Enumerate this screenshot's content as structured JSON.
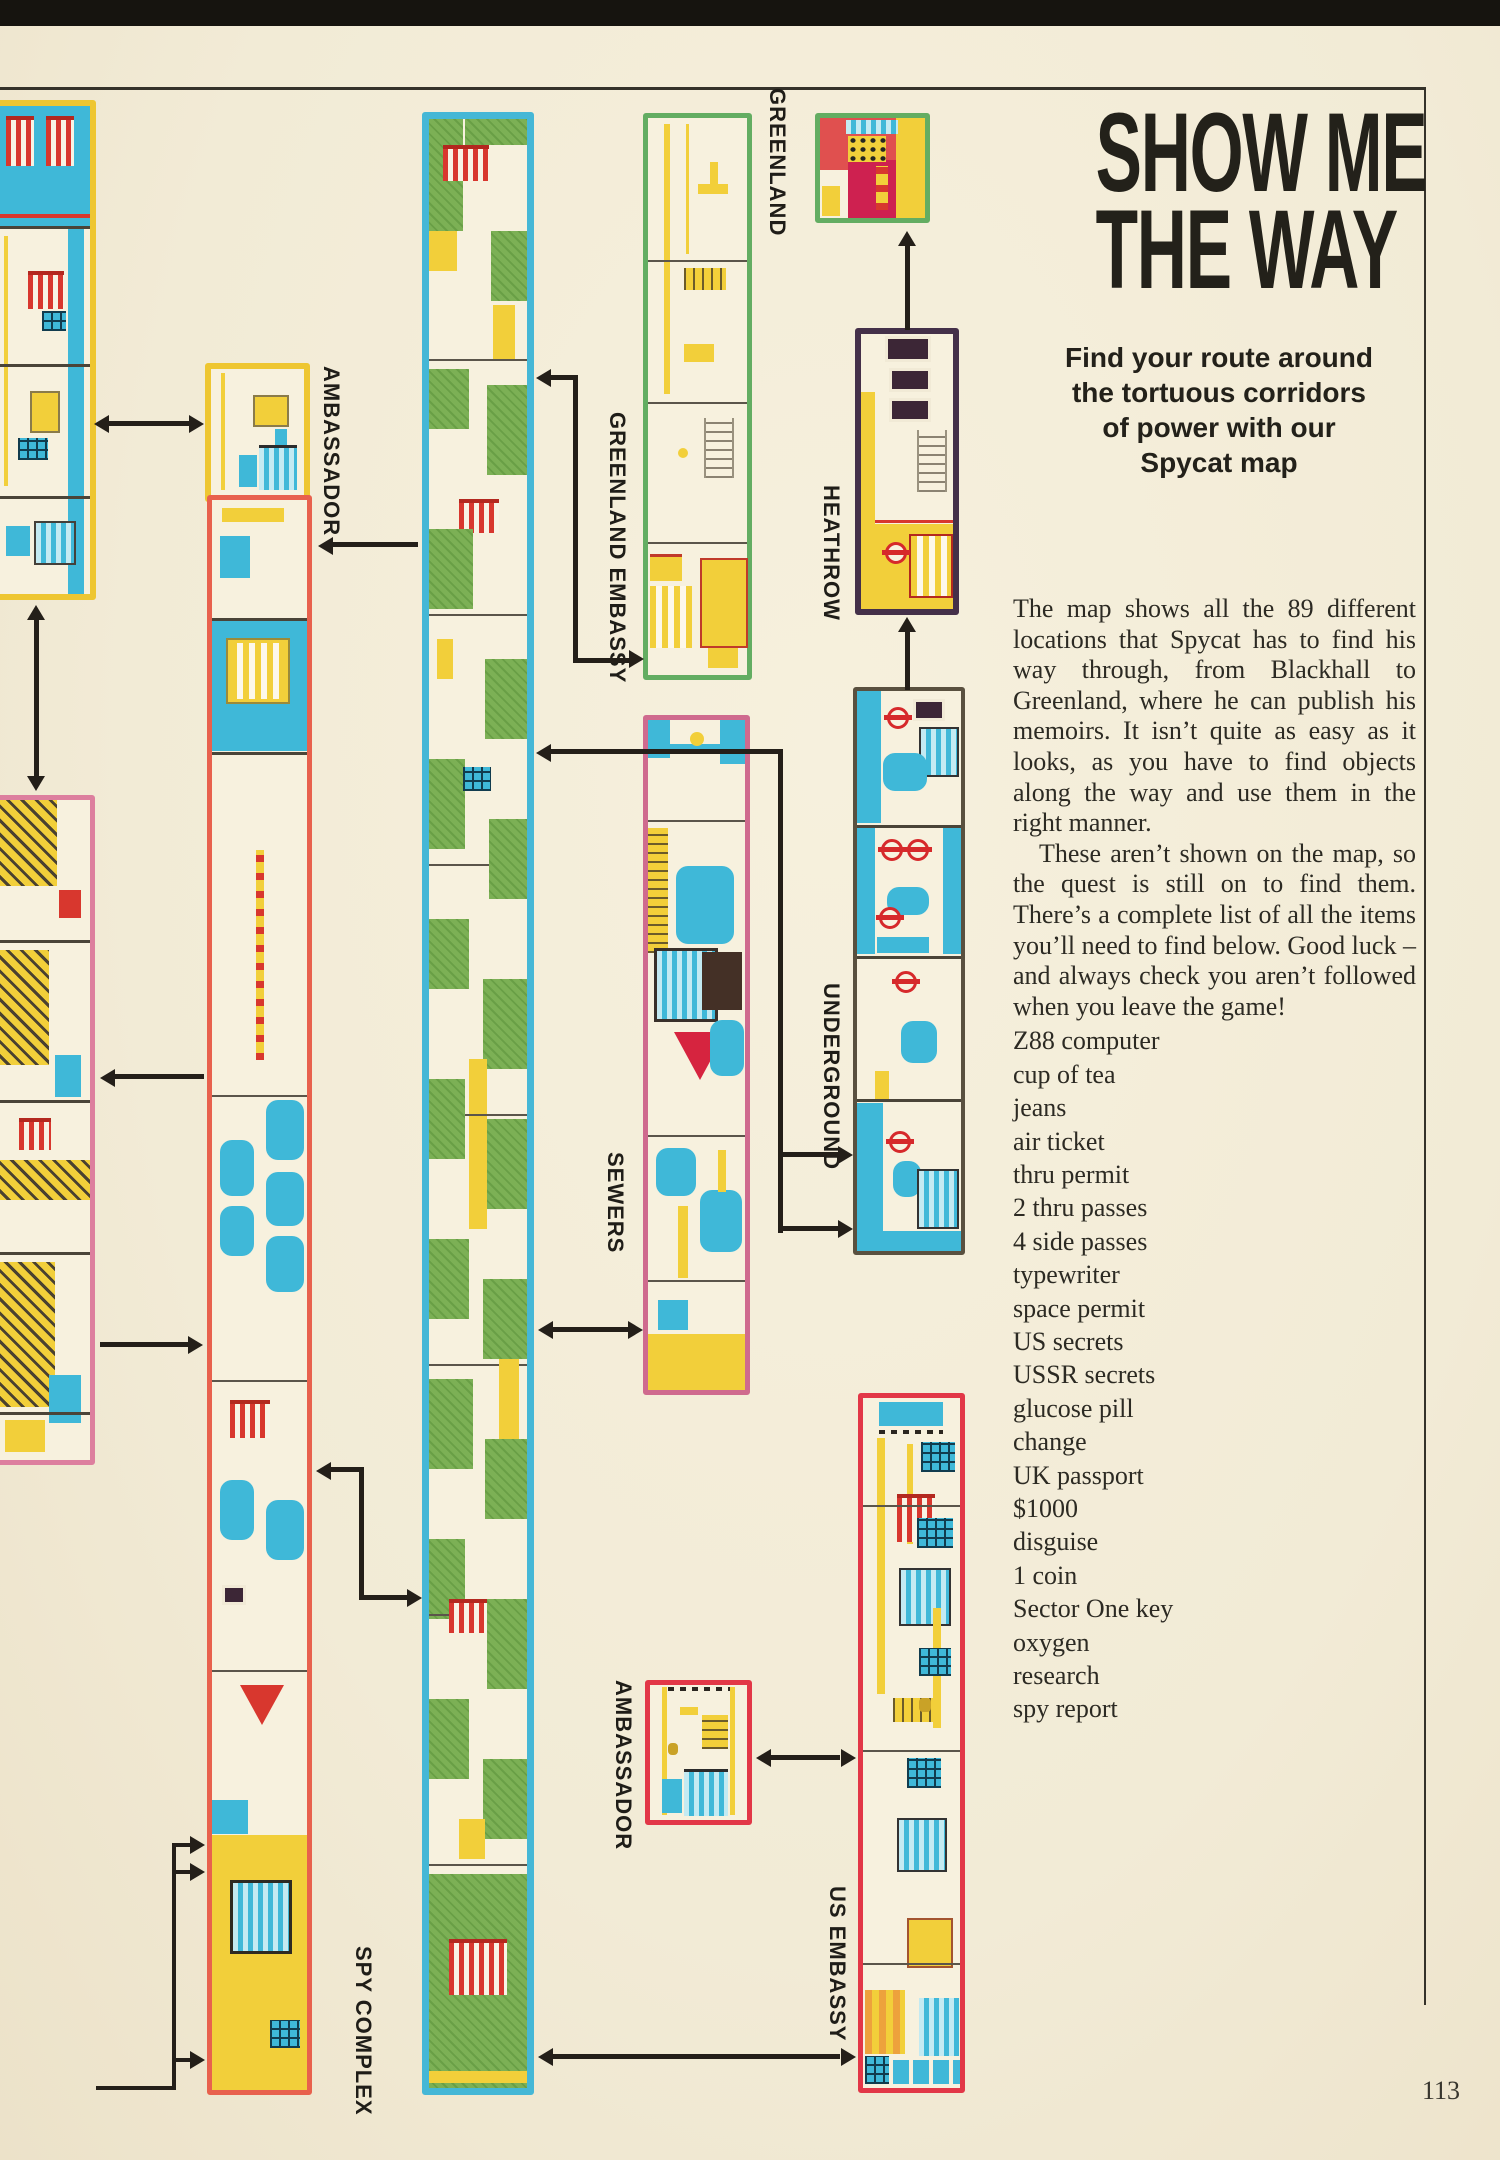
{
  "page": {
    "number": "113"
  },
  "article": {
    "title_line1": "SHOW ME",
    "title_line2": "THE WAY",
    "standfirst_lines": [
      "Find your route around",
      "the tortuous corridors",
      "of power with our",
      "Spycat map"
    ],
    "para1": "The map shows all the 89 different locations that Spycat has to find his way through, from Blackhall to Greenland, where he can publish his memoirs. It isn’t quite as easy as it looks, as you have to find objects along the way and use them in the right manner.",
    "para2": "These aren’t shown on the map, so the quest is still on to find them. There’s a complete list of all the items you’ll need to find below. Good luck – and always check you aren’t followed when you leave the game!",
    "items": [
      "Z88 computer",
      "cup of tea",
      "jeans",
      "air ticket",
      "thru permit",
      "2 thru passes",
      "4 side passes",
      "typewriter",
      "space permit",
      "US secrets",
      "USSR secrets",
      "glucose pill",
      "change",
      "UK passport",
      "$1000",
      "disguise",
      "1 coin",
      "Sector One key",
      "oxygen",
      "research",
      "spy report"
    ]
  },
  "map": {
    "labels": {
      "greenland": "GREENLAND",
      "greenland_embassy": "GREENLAND EMBASSY",
      "heathrow": "HEATHROW",
      "underground": "UNDERGROUND",
      "sewers": "SEWERS",
      "ambassador_top": "AMBASSADOR",
      "ambassador_bottom": "AMBASSADOR",
      "us_embassy": "US EMBASSY",
      "spy_complex": "SPY COMPLEX"
    }
  },
  "colors": {
    "paper": "#f2ebd6",
    "cyan": "#3fb8d8",
    "green": "#7cb055",
    "yellow": "#f2cf3a",
    "red": "#d8372e",
    "pink_border": "#dd7f9e",
    "red_border": "#e23747",
    "orange_border": "#e8614d",
    "green_border": "#63ad62",
    "dark": "#3c2636",
    "arrow": "#241f19"
  }
}
